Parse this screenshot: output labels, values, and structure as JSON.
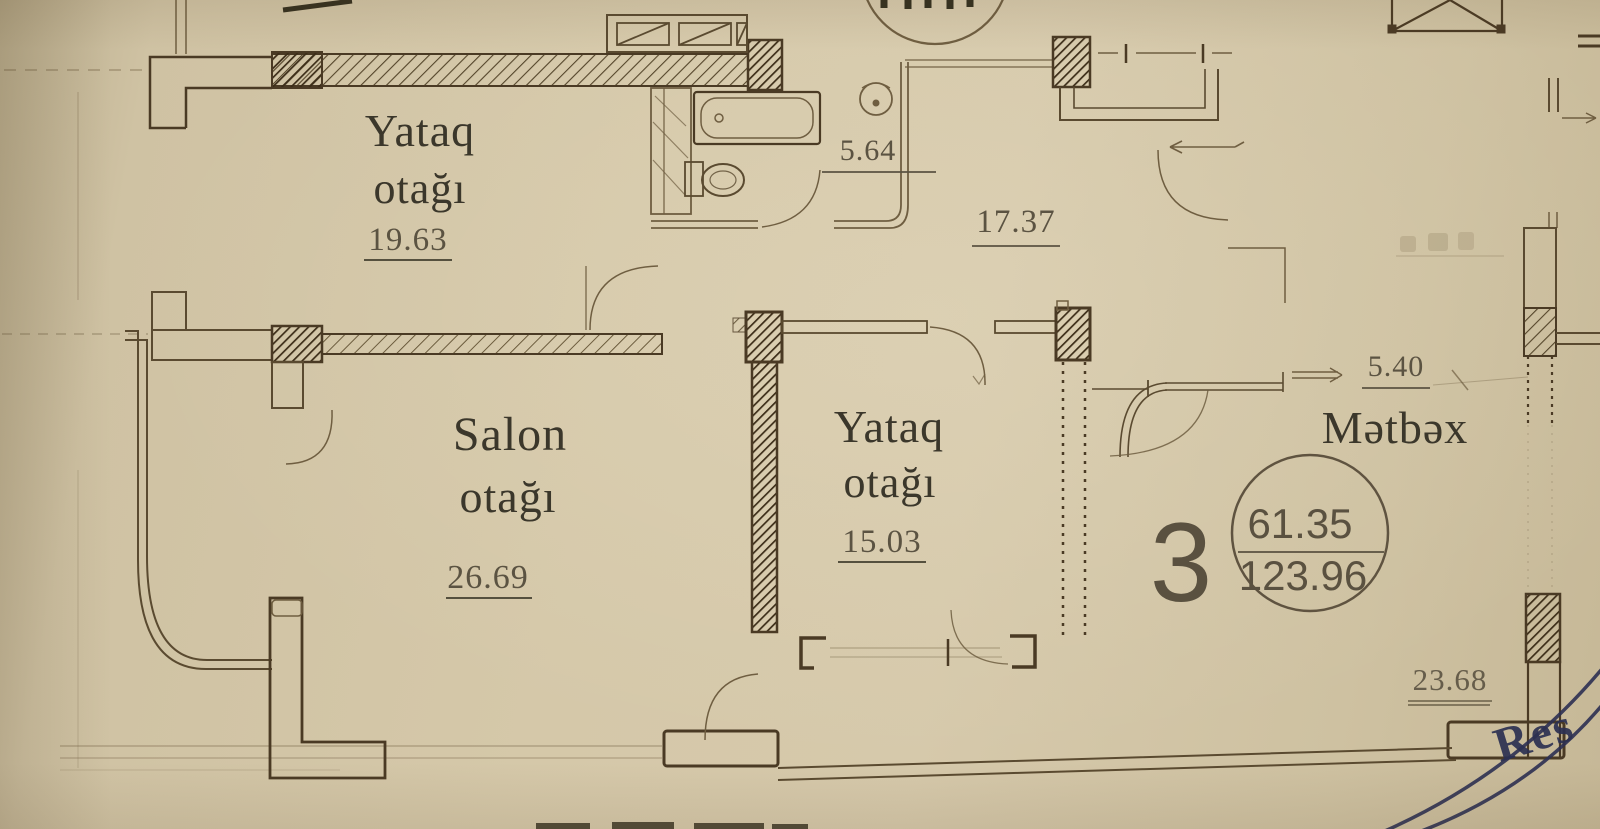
{
  "plan": {
    "rooms": {
      "bedroom_top": {
        "name_line1": "Yataq",
        "name_line2": "otağı",
        "area": "19.63"
      },
      "salon": {
        "name_line1": "Salon",
        "name_line2": "otağı",
        "area": "26.69"
      },
      "bedroom_middle": {
        "name_line1": "Yataq",
        "name_line2": "otağı",
        "area": "15.03"
      },
      "kitchen": {
        "name": "Mətbəx"
      }
    },
    "dimensions": {
      "bathroom": "5.64",
      "hallway": "17.37",
      "kitchen_niche": "5.40",
      "balcony": "23.68"
    },
    "apartment_badge": {
      "number": "3",
      "area_living": "61.35",
      "area_total": "123.96"
    },
    "stamp_text": "Res",
    "colors": {
      "paper": "#cfc2a4",
      "ink": "#4a3a24",
      "ink_soft": "#6f5e41",
      "label": "#3b372b",
      "stamp": "#2d3150"
    }
  }
}
